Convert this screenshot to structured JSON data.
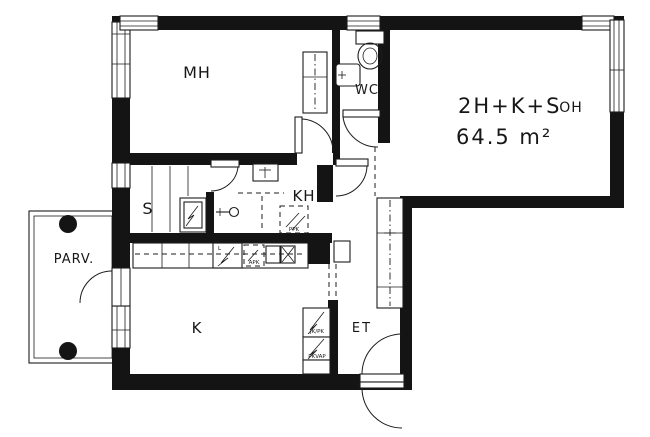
{
  "plan": {
    "title": "2H+K+S",
    "area": "64.5 m²",
    "rooms": {
      "bedroom": "MH",
      "toilet": "WC",
      "bathroom": "KH",
      "sauna": "S",
      "kitchen": "K",
      "hall": "ET",
      "balcony": "PARV.",
      "living": "OH"
    },
    "appliances": {
      "dishwasher": "APK",
      "washer_reservation": "PPK",
      "fridge_freezer": "JK/PK",
      "freezer_reservation": "PKVAP",
      "stove": "L"
    },
    "colors": {
      "wall": "#141414",
      "background": "#ffffff"
    }
  }
}
